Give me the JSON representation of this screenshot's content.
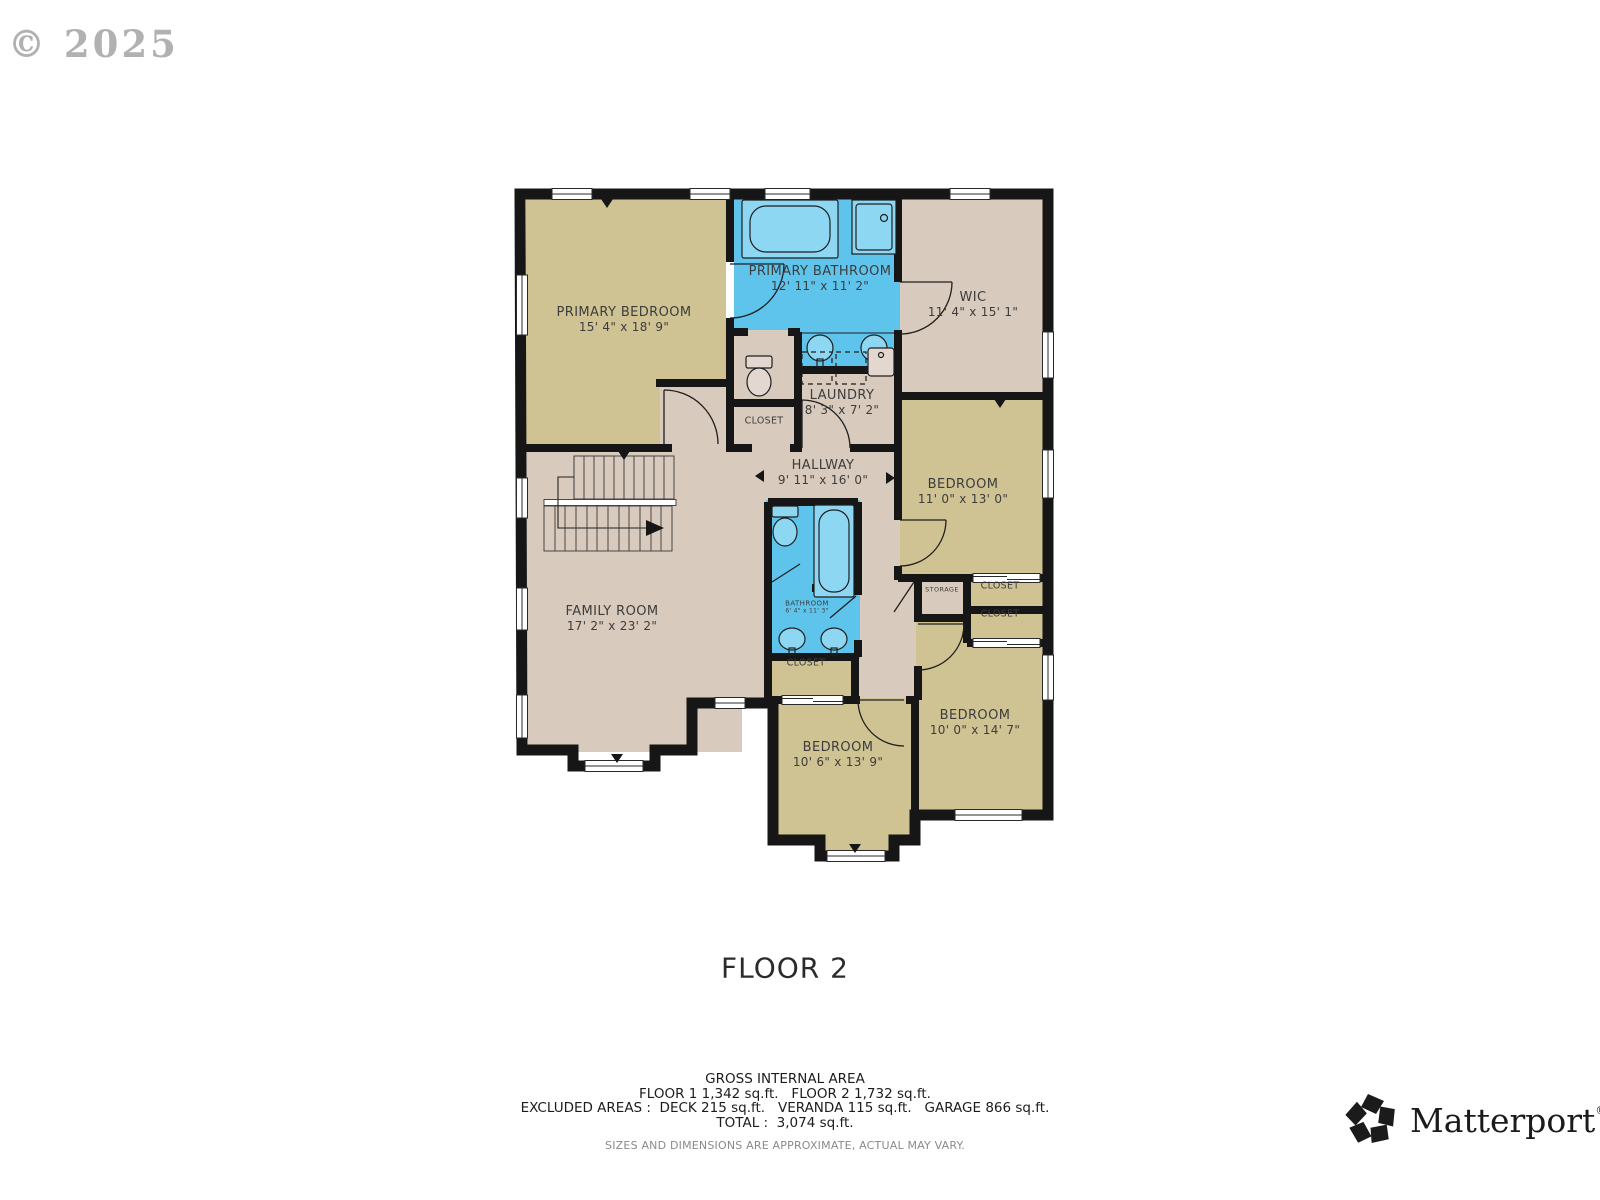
{
  "watermark": "© 2025",
  "floor_label": "FLOOR 2",
  "rooms": {
    "primary_bedroom": {
      "name": "PRIMARY BEDROOM",
      "dims": "15' 4\" x 18' 9\""
    },
    "primary_bathroom": {
      "name": "PRIMARY BATHROOM",
      "dims": "12' 11\" x 11' 2\""
    },
    "wic": {
      "name": "WIC",
      "dims": "11' 4\" x 15' 1\""
    },
    "laundry": {
      "name": "LAUNDRY",
      "dims": "8' 3\" x 7' 2\""
    },
    "closet_upper": {
      "name": "CLOSET"
    },
    "hallway": {
      "name": "HALLWAY",
      "dims": "9' 11\" x 16' 0\""
    },
    "bedroom_right": {
      "name": "BEDROOM",
      "dims": "11' 0\" x 13' 0\""
    },
    "family_room": {
      "name": "FAMILY ROOM",
      "dims": "17' 2\" x 23' 2\""
    },
    "bathroom_center": {
      "name": "BATHROOM",
      "dims": "6' 4\" x 11' 3\""
    },
    "storage": {
      "name": "STORAGE"
    },
    "closet_right_1": {
      "name": "CLOSET"
    },
    "closet_right_2": {
      "name": "CLOSET"
    },
    "closet_center": {
      "name": "CLOSET"
    },
    "bedroom_bottom_center": {
      "name": "BEDROOM",
      "dims": "10' 6\" x 13' 9\""
    },
    "bedroom_bottom_right": {
      "name": "BEDROOM",
      "dims": "10' 0\" x 14' 7\""
    }
  },
  "footer": {
    "gross_title": "GROSS INTERNAL AREA",
    "line1": "FLOOR 1 1,342 sq.ft.   FLOOR 2 1,732 sq.ft.",
    "line2": "EXCLUDED AREAS :  DECK 215 sq.ft.   VERANDA 115 sq.ft.   GARAGE 866 sq.ft.",
    "line3": "TOTAL :  3,074 sq.ft.",
    "disclaimer": "SIZES AND DIMENSIONS ARE APPROXIMATE, ACTUAL MAY VARY."
  },
  "brand": {
    "name": "Matterport",
    "registered": "®"
  },
  "colors": {
    "room_tan": "#cfc394",
    "room_pink": "#d8cabc",
    "bathroom_blue": "#5fc4ec",
    "fixture_blue": "#8ed7f2",
    "wall": "#161616"
  }
}
